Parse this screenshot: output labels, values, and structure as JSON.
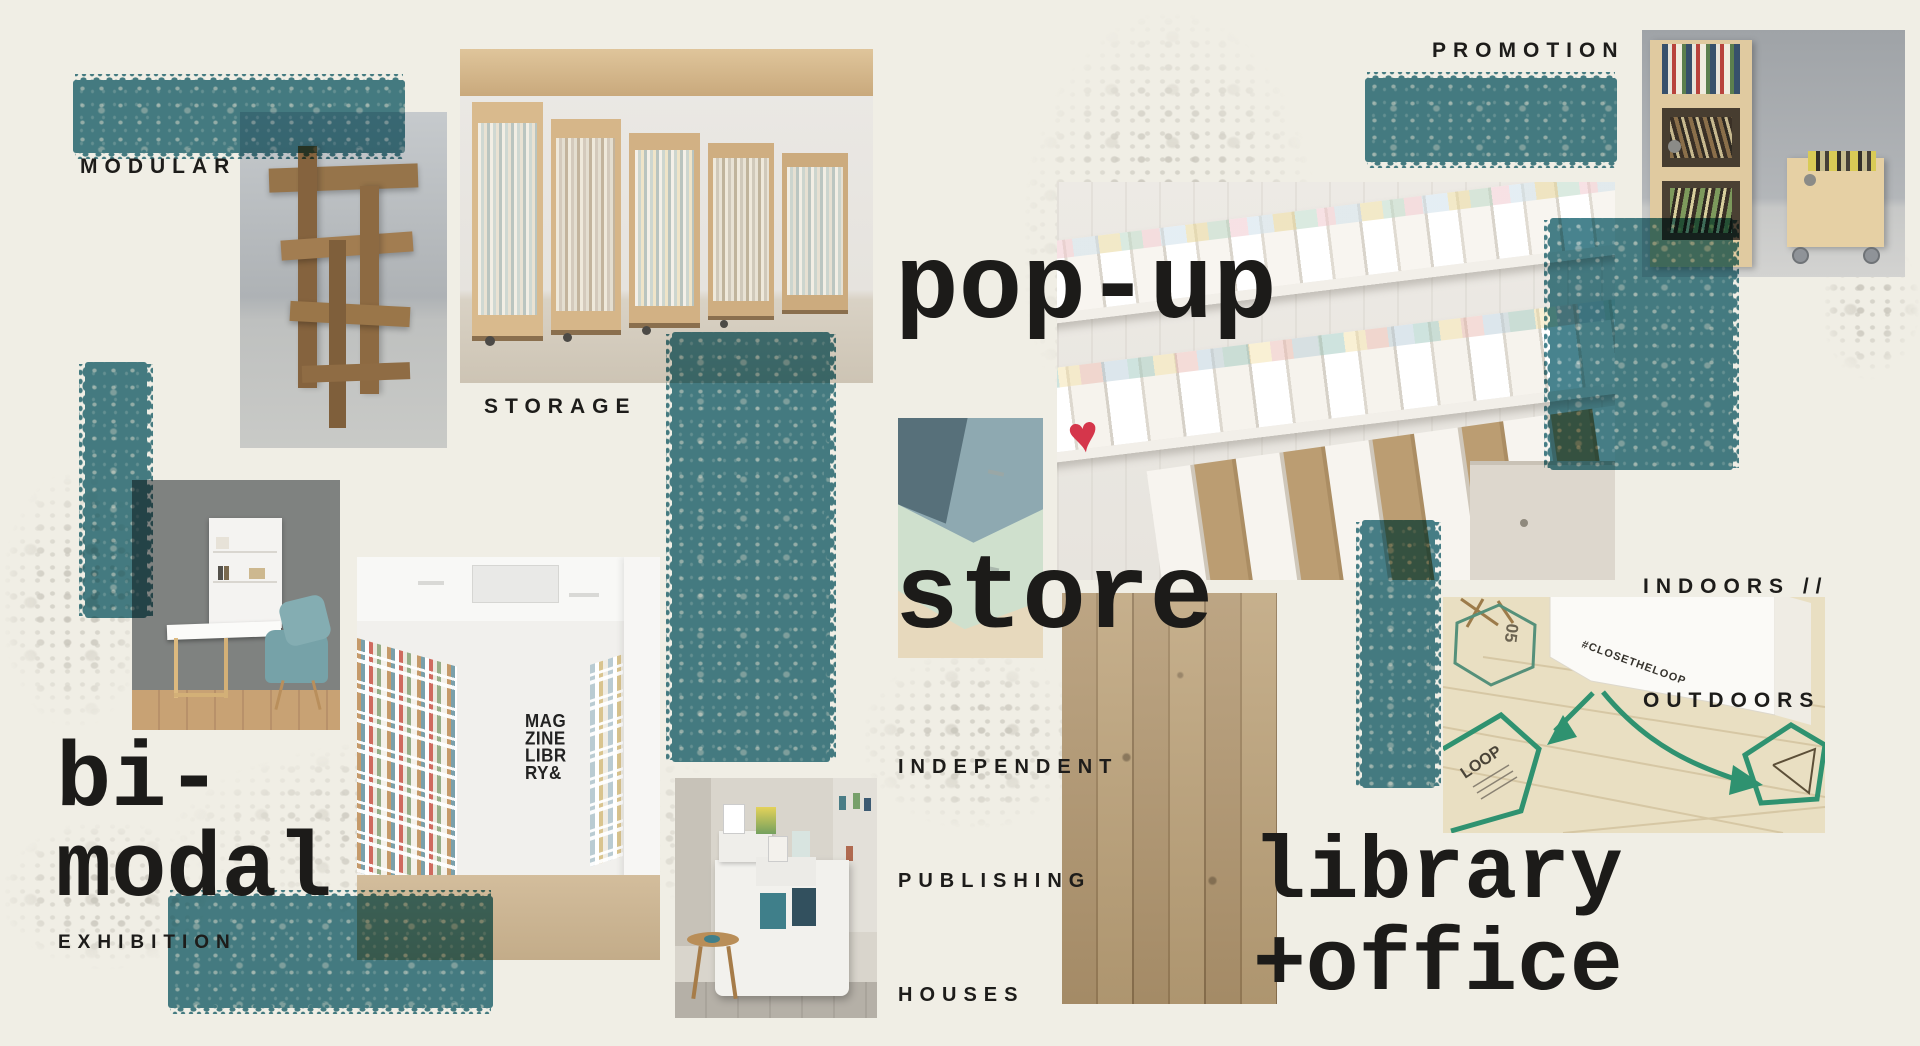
{
  "palette": {
    "background": "#f0eee5",
    "teal": "#3e7c88",
    "ink": "#1e1d1b",
    "splotch_gray": "#cfccc2"
  },
  "labels": {
    "modular": "MODULAR",
    "storage": "STORAGE",
    "popup_line1": "pop-up",
    "popup_line2": "store",
    "promotion": "PROMOTION",
    "indoors_line1": "INDOORS //",
    "indoors_line2": "OUTDOORS",
    "independent_line1": "INDEPENDENT",
    "independent_line2": "PUBLISHING",
    "independent_line3": "HOUSES",
    "bimodal_line1": "bi-",
    "bimodal_line2": "modal",
    "exhibition": "EXHIBITION",
    "library_line1": "library",
    "library_line2": "+office"
  },
  "photo_texts": {
    "magazine_wall": [
      "MAG",
      "ZINE",
      "LIBR",
      "RY&"
    ],
    "floor_hashtag": "#CLOSETHELOOP",
    "floor_loop": "LOOP",
    "floor_number": "05"
  },
  "photos": [
    "cardboard-display",
    "rolling-storage-shelves",
    "stationery-shop-shelves",
    "fold-down-desk",
    "magazine-library-gallery",
    "stepped-magazine-cart",
    "plywood-shelf-detail",
    "wood-planks",
    "floor-tape-graphics",
    "plywood-storage-boxes"
  ]
}
